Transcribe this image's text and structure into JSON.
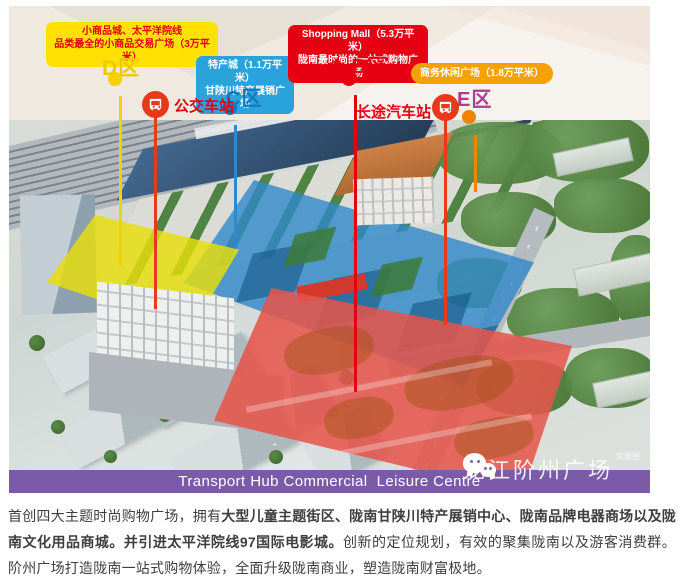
{
  "header": {
    "callouts": {
      "d": {
        "line1": "小商品城、太平洋院线",
        "line2": "品类最全的小商品交易广场（3万平米）",
        "bg": "#ffe103",
        "text_color": "#e60012"
      },
      "c": {
        "line1": "特产城（1.1万平米）",
        "line2": "甘陕川特产展销广场",
        "bg": "#2aa2db",
        "text_color": "#ffffff"
      },
      "ab": {
        "line1": "Shopping Mall（5.3万平米）",
        "line2": "陇南最时尚的一站式购物广场",
        "bg": "#e60012",
        "text_color": "#ffffff"
      },
      "e": {
        "line1": "商务休闲广场（1.8万平米）",
        "bg": "#f5a100",
        "text_color": "#ffffff"
      }
    },
    "zones": {
      "d": {
        "label": "D区",
        "label_color": "#eec800",
        "pin_color": "#f3d103"
      },
      "c": {
        "label": "C区",
        "label_color": "#1478be",
        "pin_color": "#1478be"
      },
      "ab": {
        "label": "A.B区",
        "label_color": "#e60012",
        "pin_color": "#e60012"
      },
      "e": {
        "label": "E区",
        "label_color": "#b23a8e",
        "pin_color": "#f08300"
      }
    },
    "stations": {
      "bus": {
        "label": "公交车站",
        "color": "#e60012",
        "icon": "bus-icon"
      },
      "coach": {
        "label": "长途汽车站",
        "color": "#e60012",
        "icon": "bus-icon"
      }
    }
  },
  "map": {
    "banner_text": "Transport Hub Commercial  Leisure Centre",
    "banner_bg": "#7b5ba7",
    "watermark": {
      "icon": "wechat-icon",
      "label": "龙江阶州广场",
      "superscript": "实景图"
    }
  },
  "paragraph": {
    "segments": [
      {
        "text": "首创四大主题时尚购物广场，拥有",
        "bold": false
      },
      {
        "text": "大型儿童主题街区、陇南甘陕川特产展销中心、陇南品牌电器商场以及陇南文化用品商城。并引进太平洋院线97国际电影城。",
        "bold": true
      },
      {
        "text": "创新的定位规划，有效的聚集陇南以及游客消费群。阶州广场打造陇南一站式购物体验，全面升级陇南商业，塑造陇南财富极地。",
        "bold": false
      }
    ]
  }
}
